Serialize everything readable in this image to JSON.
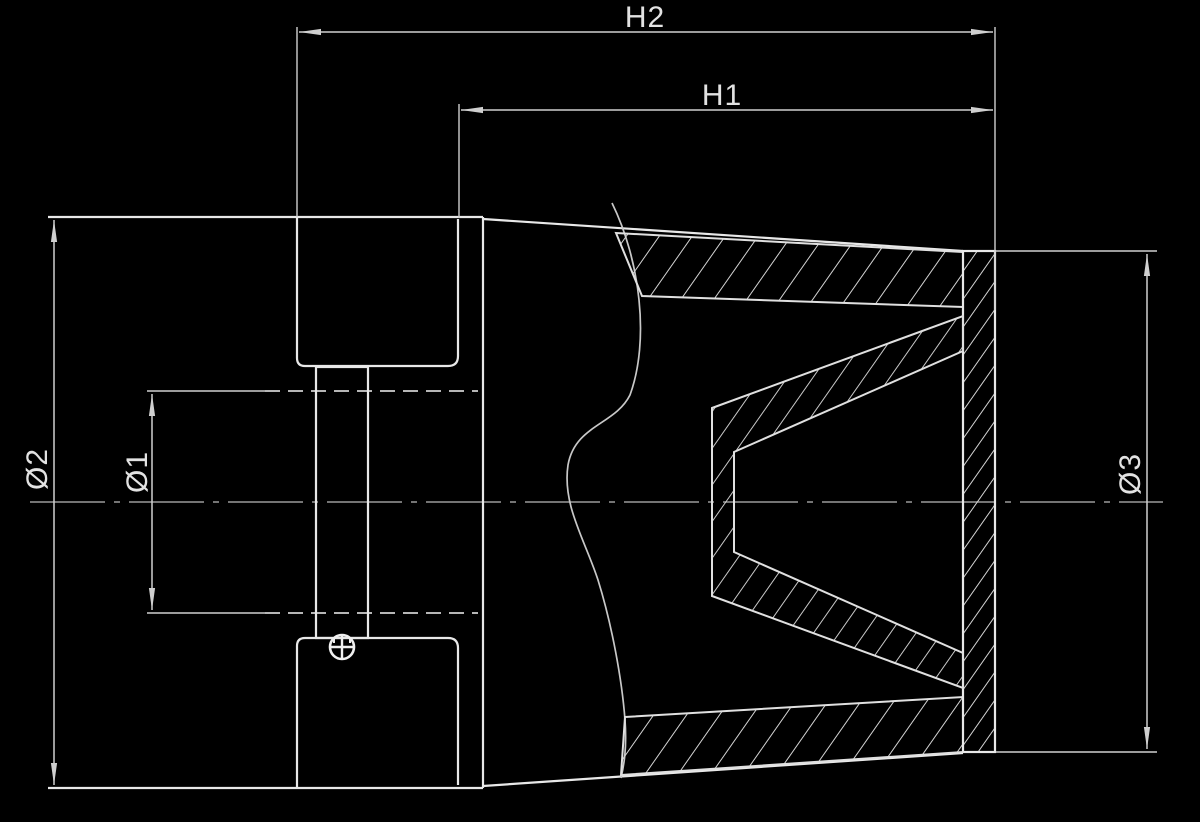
{
  "drawing": {
    "type": "technical-section-drawing",
    "subject": "conical-air-filter-cross-section",
    "colors": {
      "background": "#000000",
      "object_line": "#e8e8e8",
      "dimension_line": "#cfcfcf",
      "centerline": "#9a9a9a",
      "hatch": "#d4d4d4",
      "text": "#e2e2e2"
    },
    "dimensions": {
      "h2": {
        "label": "H2"
      },
      "h1": {
        "label": "H1"
      },
      "d2": {
        "label": "Ø2"
      },
      "d1": {
        "label": "Ø1"
      },
      "d3": {
        "label": "Ø3"
      }
    }
  }
}
